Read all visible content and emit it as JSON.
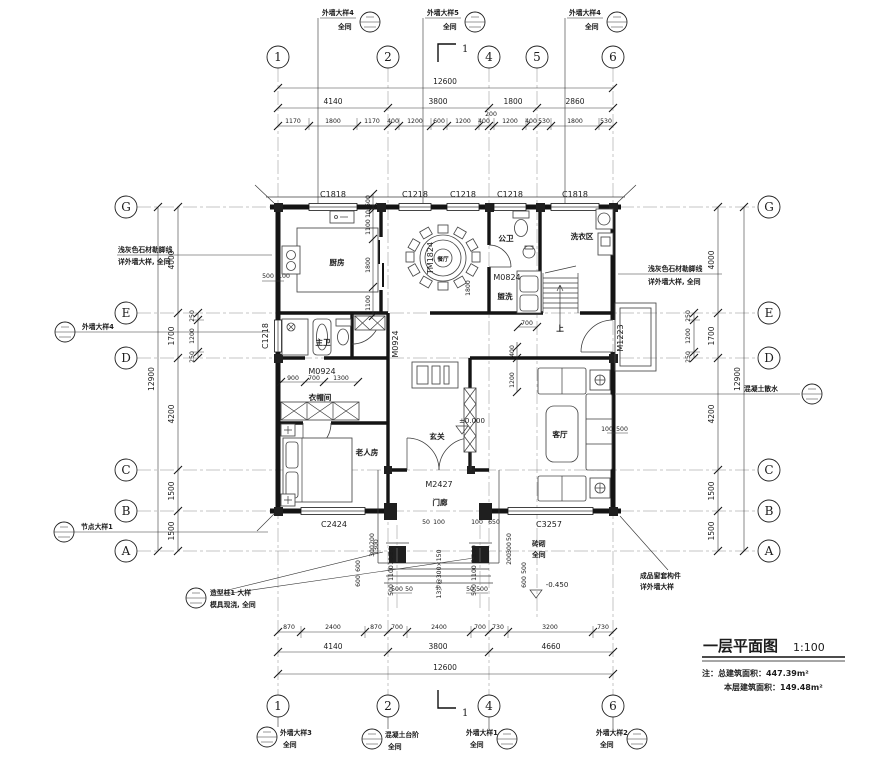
{
  "title": {
    "name": "一层平面图",
    "scale": "1:100",
    "note_prefix": "注：",
    "line1": "总建筑面积：447.39m²",
    "line2": "本层建筑面积：149.48m²"
  },
  "grid": {
    "top": [
      "1",
      "2",
      "4",
      "5",
      "6"
    ],
    "bottom": [
      "1",
      "2",
      "4",
      "6"
    ],
    "left": [
      "G",
      "E",
      "D",
      "C",
      "B",
      "A"
    ],
    "right": [
      "G",
      "E",
      "D",
      "C",
      "B",
      "A"
    ]
  },
  "rooms": {
    "kitchen": "厨房",
    "dining": "餐厅",
    "guest_bath": "公卫",
    "wash": "盥洗",
    "laundry": "洗衣区",
    "master_bath": "主卫",
    "closet": "衣帽间",
    "elder": "老人房",
    "foyer": "玄关",
    "porch": "门廊",
    "living": "客厅",
    "stairs_up": "上"
  },
  "openings": {
    "win_top1": "C1818",
    "win_top2": "C1218",
    "win_top3": "C1218",
    "win_top4": "C1218",
    "win_top5": "C1818",
    "win_left": "C1218",
    "door_dining": "TM1824",
    "door_guest_bath": "M0824",
    "door_master_bath": "M0924",
    "door_closet": "M0924",
    "door_right": "M1223",
    "door_entry": "M2427",
    "win_elder": "C2424",
    "win_living": "C3257"
  },
  "levels": {
    "zero": "±0.000",
    "porch": "-0.450"
  },
  "dims": {
    "top_total": "12600",
    "top_axis": [
      "4140",
      "3800",
      "1800",
      "2860"
    ],
    "top_detail": [
      "1170",
      "1800",
      "1170",
      "400",
      "1200",
      "600",
      "1200",
      "400",
      "200",
      "1200",
      "400",
      "530",
      "1800",
      "530"
    ],
    "bottom_detail": [
      "870",
      "2400",
      "870",
      "700",
      "2400",
      "700",
      "730",
      "3200",
      "730"
    ],
    "bottom_axis": [
      "4140",
      "3800",
      "4660"
    ],
    "bottom_total": "12600",
    "left_axis": [
      "4000",
      "1700",
      "4200",
      "1500",
      "1500"
    ],
    "left_total": "12900",
    "left_detail": [
      "250",
      "1200",
      "250"
    ],
    "right_axis": [
      "4000",
      "1700",
      "4200",
      "1500",
      "1500"
    ],
    "right_total": "12900",
    "right_detail": [
      "250",
      "1200",
      "250"
    ],
    "kitchen_chain": [
      "500",
      "100",
      "1100",
      "1800",
      "1100"
    ],
    "kitchen_left": [
      "500",
      "100"
    ],
    "closet_chain": [
      "900",
      "700",
      "1300"
    ],
    "wash_width": "700",
    "dining_table": "1800",
    "living_chain": [
      "400",
      "1200"
    ],
    "living_right": [
      "100",
      "500"
    ],
    "porch_left_steps": [
      "500",
      "50"
    ],
    "porch_right_steps": [
      "50",
      "500"
    ],
    "porch_left_chain": [
      "200",
      "300",
      "600",
      "600"
    ],
    "porch_right_chain": [
      "50",
      "300",
      "200",
      "500",
      "600"
    ],
    "porch_col_left": [
      "50",
      "100",
      "1100",
      "500"
    ],
    "porch_col_right": [
      "100",
      "50",
      "1100",
      "500"
    ],
    "elder_bottom": [
      "50",
      "100"
    ],
    "living_bottom": [
      "100",
      "650"
    ],
    "porch_depth": "1300"
  },
  "notes": {
    "stone_left1": "浅灰色石材勒脚线",
    "stone_left2": "详外墙大样, 全同",
    "stone_right1": "浅灰色石材勒脚线",
    "stone_right2": "详外墙大样, 全同",
    "window_trim1": "成品窗套构件",
    "window_trim2": "详外墙大样",
    "brick1": "砖砌",
    "brick2": "全同",
    "stair_note": "13步@300×150",
    "apron": "混凝土散水",
    "section_no": "1"
  },
  "callouts": {
    "top1": {
      "t": "外墙大样4",
      "s": "全同"
    },
    "top2": {
      "t": "外墙大样5",
      "s": "全同"
    },
    "top3": {
      "t": "外墙大样4",
      "s": "全同"
    },
    "left1": "外墙大样4",
    "left2": "节点大样1",
    "col1": {
      "t": "造型柱1 大样",
      "s": "模具现浇, 全同"
    },
    "bot1": {
      "t": "外墙大样3",
      "s": "全同"
    },
    "bot2": {
      "t": "混凝土台阶",
      "s": "全同"
    },
    "bot3": {
      "t": "外墙大样1",
      "s": "全同"
    },
    "bot4": {
      "t": "外墙大样2",
      "s": "全同"
    }
  }
}
